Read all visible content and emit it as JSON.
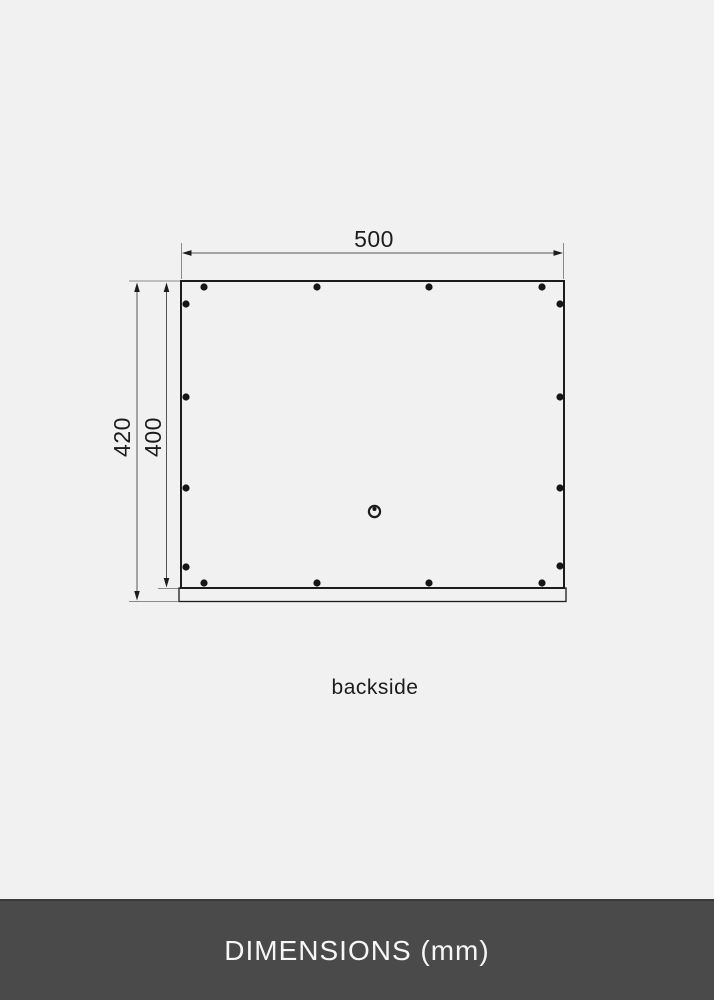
{
  "page": {
    "background": "#f1f1f2"
  },
  "diagram": {
    "view_label": "backside",
    "dimensions": {
      "width": "500",
      "height_total": "420",
      "height_frame": "400"
    },
    "colors": {
      "outline": "#1c1c1c",
      "dimension_line": "#555555",
      "extension_line": "#8a8a8a"
    }
  },
  "footer": {
    "label": "DIMENSIONS (mm)",
    "background": "#4a4a4b",
    "text_color": "#f6f6f6"
  }
}
